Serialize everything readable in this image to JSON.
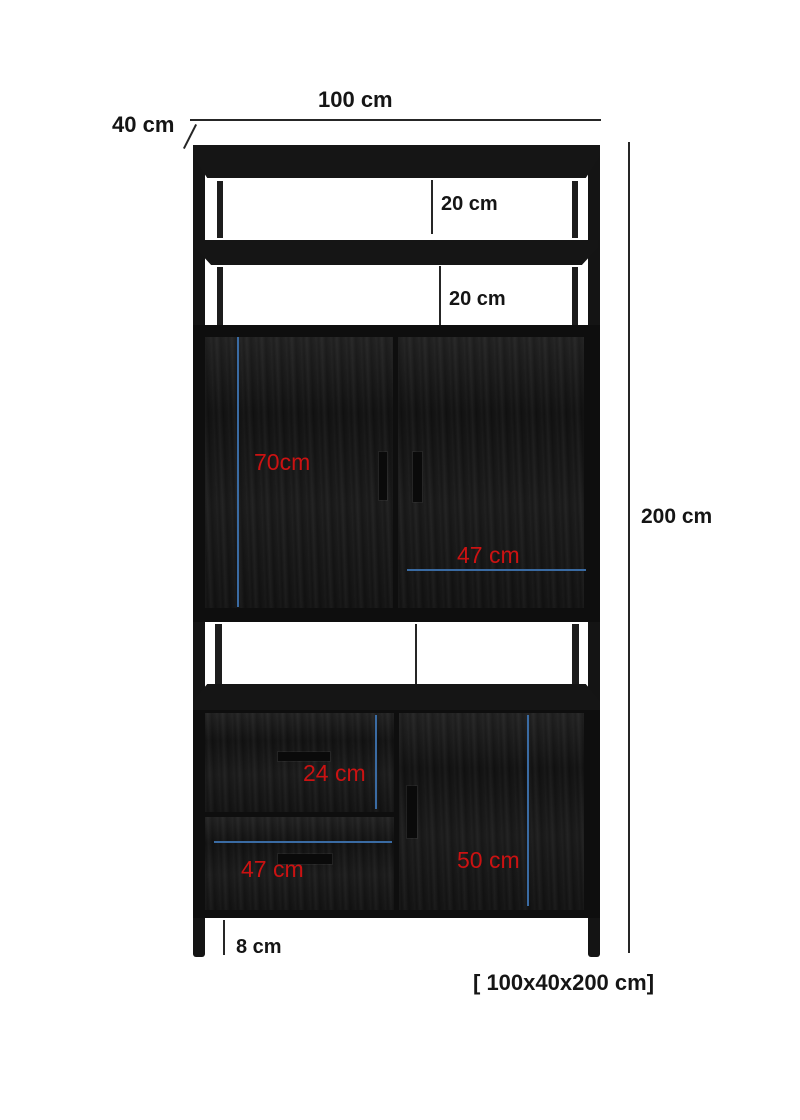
{
  "diagram": {
    "type": "furniture-dimension-diagram",
    "subject": "black two-door cabinet with shelves and drawers",
    "labels": {
      "width_top": "100 cm",
      "depth": "40 cm",
      "height": "200 cm",
      "shelf_gap_1": "20 cm",
      "shelf_gap_2": "20 cm",
      "upper_door_height": "70cm",
      "upper_door_width": "47 cm",
      "top_drawer_height": "24 cm",
      "bottom_drawer_width": "47 cm",
      "lower_door_height": "50 cm",
      "leg_height": "8 cm",
      "overall_size": "[ 100x40x200 cm]"
    },
    "colors": {
      "background": "#ffffff",
      "cabinet_black": "#141414",
      "annotation_red": "#cc1212",
      "measure_blue": "#3a6ba3",
      "dimension_line": "#262626",
      "text_black": "#151515"
    }
  }
}
